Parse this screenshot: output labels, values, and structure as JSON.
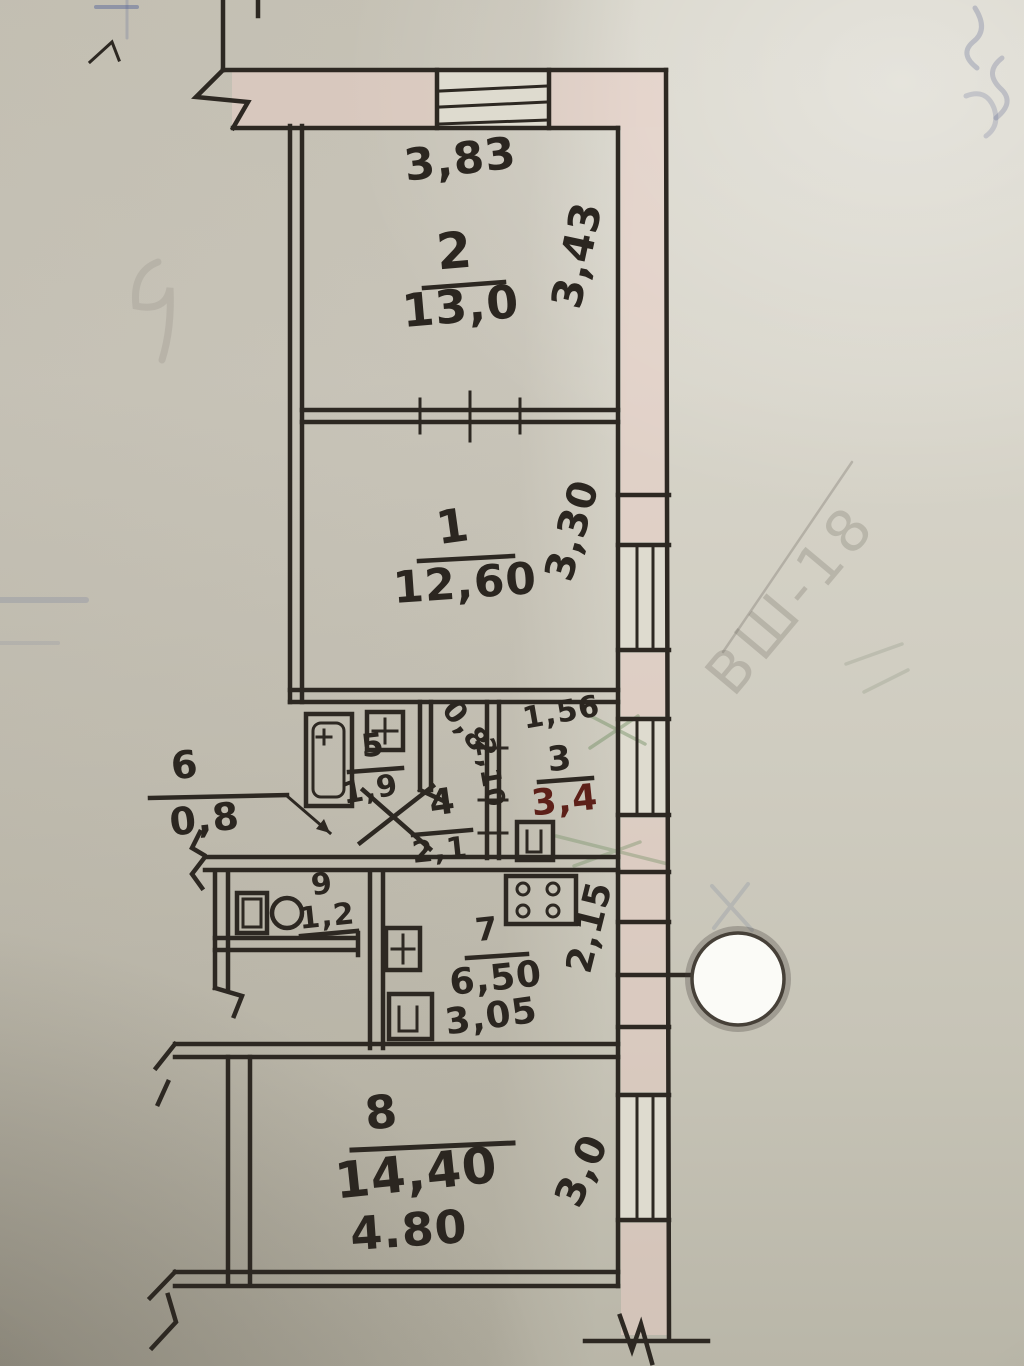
{
  "rooms": {
    "r1": {
      "number": "1",
      "area": "12,60"
    },
    "r2": {
      "number": "2",
      "area": "13,0"
    },
    "r3": {
      "number": "3",
      "area": "3,4"
    },
    "r4": {
      "number": "4",
      "area": "2,1"
    },
    "r5": {
      "number": "5",
      "area": "1,9"
    },
    "r6": {
      "number": "6",
      "area": "0,8"
    },
    "r7": {
      "number": "7",
      "area": "6,50"
    },
    "r8": {
      "number": "8",
      "area": "14,40"
    },
    "r9": {
      "number": "9",
      "area": "1,2"
    }
  },
  "dimensions": {
    "top_width": "3,83",
    "room2_depth": "3,43",
    "room1_depth": "3,30",
    "room3_width": "1,56",
    "door_width": "0,8",
    "hall_length": "2,10",
    "kitchen_depth": "2,15",
    "kitchen_width": "3,05",
    "room8_width": "4.80",
    "room8_depth": "3,0"
  },
  "annotations": {
    "pencil_code": "ВШ-18"
  }
}
